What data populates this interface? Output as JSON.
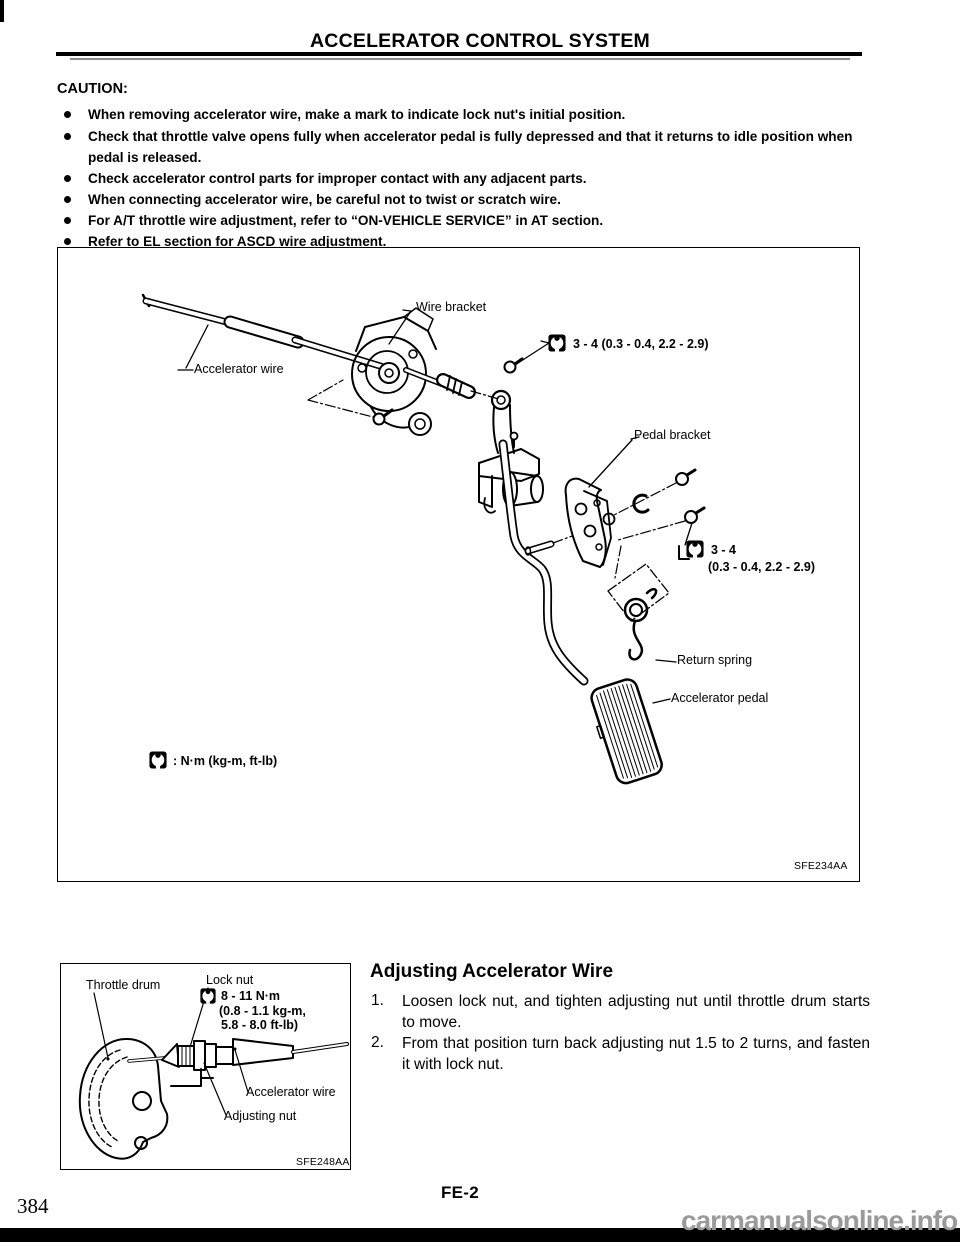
{
  "page": {
    "title": "ACCELERATOR CONTROL SYSTEM",
    "footer_code": "FE-2",
    "page_number": "384",
    "watermark": "carmanualsonline.info"
  },
  "colors": {
    "ink": "#000000",
    "paper": "#ffffff",
    "watermark_gray": "#9a9a9a"
  },
  "icons": {
    "torque_symbol": "torque-wrench-icon"
  },
  "caution": {
    "heading": "CAUTION:",
    "items": [
      "When removing accelerator wire, make a mark to indicate lock nut's initial position.",
      "Check that throttle valve opens fully when accelerator pedal is fully depressed and that it returns to idle position when pedal is released.",
      "Check accelerator control parts for improper contact with any adjacent parts.",
      "When connecting accelerator wire, be careful not to twist or scratch wire.",
      "For A/T throttle wire adjustment, refer to “ON-VEHICLE SERVICE” in AT section.",
      "Refer to EL section for ASCD wire adjustment."
    ]
  },
  "figure_main": {
    "labels": {
      "wire_bracket": "Wire bracket",
      "accelerator_wire": "Accelerator wire",
      "pedal_bracket": "Pedal bracket",
      "return_spring": "Return spring",
      "accelerator_pedal": "Accelerator pedal"
    },
    "torque_callout_1": "3 - 4 (0.3 - 0.4, 2.2 - 2.9)",
    "torque_callout_2_line1": "3 - 4",
    "torque_callout_2_line2": "(0.3 - 0.4, 2.2 - 2.9)",
    "legend": ": N·m (kg-m, ft-lb)",
    "figure_code": "SFE234AA"
  },
  "figure_adjust": {
    "labels": {
      "throttle_drum": "Throttle drum",
      "lock_nut": "Lock nut",
      "accelerator_wire": "Accelerator wire",
      "adjusting_nut": "Adjusting nut"
    },
    "torque_line1": "8 - 11 N·m",
    "torque_line2": "(0.8 - 1.1 kg-m,",
    "torque_line3": "5.8 - 8.0 ft-lb)",
    "figure_code": "SFE248AA"
  },
  "adjust_section": {
    "heading": "Adjusting Accelerator Wire",
    "steps": [
      {
        "num": "1.",
        "text": "Loosen lock nut, and tighten adjusting nut until throttle drum starts to move."
      },
      {
        "num": "2.",
        "text": "From that position turn back adjusting nut 1.5 to 2 turns, and fasten it with lock nut."
      }
    ]
  }
}
